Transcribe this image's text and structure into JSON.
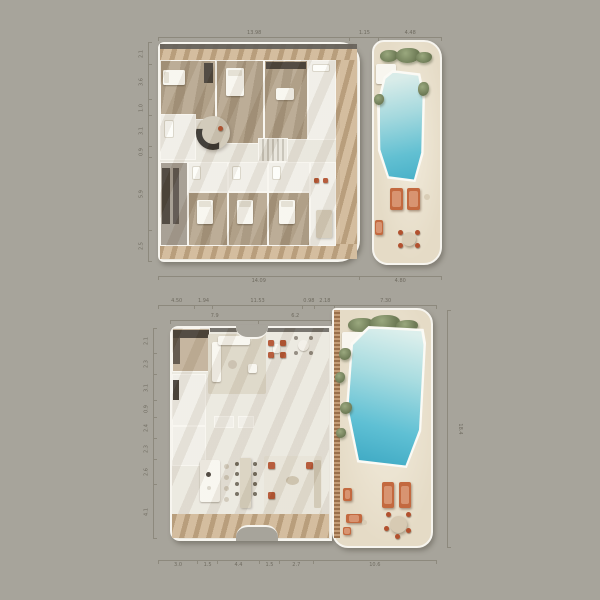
{
  "canvas": {
    "background": "#a7a49b",
    "width": 600,
    "height": 600
  },
  "palette": {
    "wall_white": "#f7f5ef",
    "roof_edge": "#64615a",
    "deck_wood": "#cdb391",
    "terrace_sand": "#e5dbc6",
    "bedroom_floor": "#b1a087",
    "interior_floor": "#ebe8df",
    "pool_deep": "#3ba7c2",
    "pool_shallow": "#dcefec",
    "greenery": "#7e8b62",
    "terracotta_furniture": "#c3693f",
    "red_chair": "#b2512e",
    "dark_furniture": "#463f36",
    "dimension_line": "#8d897d"
  },
  "plans": {
    "upper": {
      "title": "upper-floor-plan",
      "dims_top": [
        {
          "w": 68,
          "label": "13.98"
        },
        {
          "w": 10,
          "label": "1.15"
        },
        {
          "w": 22,
          "label": "4.48"
        }
      ],
      "dims_bottom": [
        {
          "w": 71,
          "label": "14.09"
        },
        {
          "w": 29,
          "label": "4.80"
        }
      ],
      "dims_left": [
        {
          "w": 10,
          "label": "2.1"
        },
        {
          "w": 16,
          "label": "3.6"
        },
        {
          "w": 7,
          "label": "1.0"
        },
        {
          "w": 14,
          "label": "3.1"
        },
        {
          "w": 5,
          "label": "0.9"
        },
        {
          "w": 34,
          "label": "5.9"
        },
        {
          "w": 14,
          "label": "2.5"
        }
      ]
    },
    "lower": {
      "title": "lower-floor-plan",
      "dims_top": [
        {
          "w": 13,
          "label": "4.50"
        },
        {
          "w": 6,
          "label": "1.94"
        },
        {
          "w": 33,
          "label": "11.53"
        },
        {
          "w": 4,
          "label": "0.98"
        },
        {
          "w": 7,
          "label": "2.18"
        },
        {
          "w": 37,
          "label": "7.30"
        }
      ],
      "dims_top_inner": [
        {
          "w": 55,
          "label": "7.9"
        },
        {
          "w": 45,
          "label": "6.2"
        }
      ],
      "dims_left": [
        {
          "w": 12,
          "label": "2.1"
        },
        {
          "w": 10,
          "label": "2.3"
        },
        {
          "w": 12,
          "label": "3.1"
        },
        {
          "w": 8,
          "label": "0.9"
        },
        {
          "w": 10,
          "label": "2.4"
        },
        {
          "w": 10,
          "label": "2.3"
        },
        {
          "w": 12,
          "label": "2.6"
        },
        {
          "w": 26,
          "label": "4.1"
        }
      ],
      "dims_right": [
        {
          "w": 100,
          "label": "18.4"
        }
      ],
      "dims_bottom": [
        {
          "w": 14,
          "label": "3.0"
        },
        {
          "w": 7,
          "label": "1.5"
        },
        {
          "w": 15,
          "label": "4.4"
        },
        {
          "w": 7,
          "label": "1.5"
        },
        {
          "w": 12,
          "label": "2.7"
        },
        {
          "w": 45,
          "label": "10.6"
        }
      ]
    }
  }
}
